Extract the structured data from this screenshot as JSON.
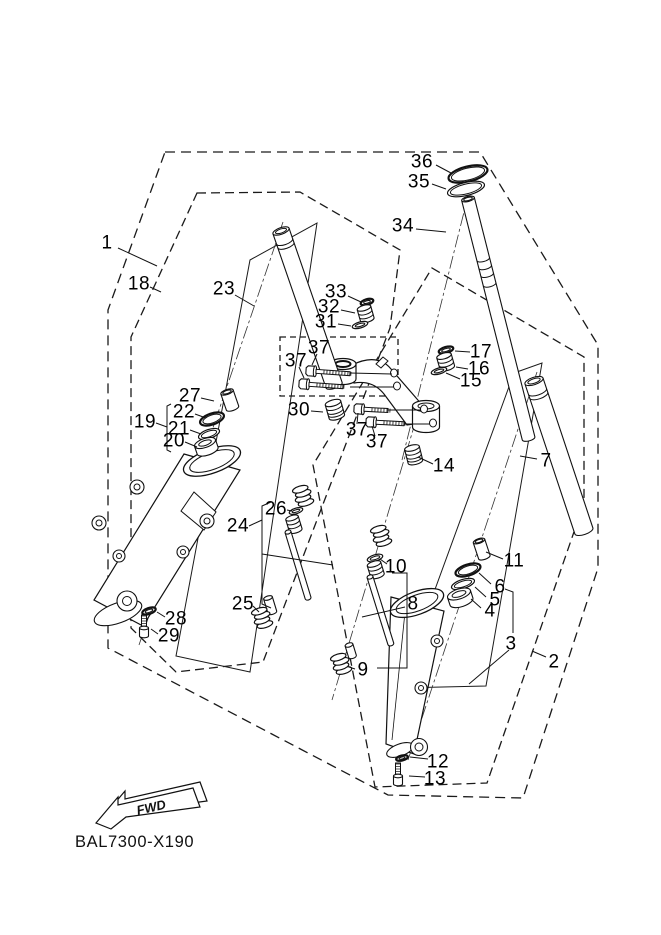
{
  "diagram": {
    "drawing_code": "BAL7300-X190",
    "fwd_label": "FWD",
    "callouts": [
      {
        "n": "1",
        "x": 107,
        "y": 243,
        "leader": [
          118,
          248,
          157,
          266
        ]
      },
      {
        "n": "18",
        "x": 139,
        "y": 284,
        "leader": [
          150,
          287,
          161,
          292
        ]
      },
      {
        "n": "23",
        "x": 224,
        "y": 289,
        "leader": [
          235,
          295,
          254,
          306
        ]
      },
      {
        "n": "36",
        "x": 422,
        "y": 162,
        "leader": [
          436,
          165,
          451,
          173
        ]
      },
      {
        "n": "35",
        "x": 419,
        "y": 182,
        "leader": [
          432,
          184,
          446,
          189
        ]
      },
      {
        "n": "34",
        "x": 403,
        "y": 226,
        "leader": [
          416,
          229,
          446,
          232
        ]
      },
      {
        "n": "33",
        "x": 336,
        "y": 292,
        "leader": [
          348,
          296,
          361,
          302
        ]
      },
      {
        "n": "32",
        "x": 329,
        "y": 307,
        "leader": [
          341,
          310,
          355,
          313
        ]
      },
      {
        "n": "31",
        "x": 326,
        "y": 322,
        "leader": [
          338,
          324,
          351,
          326
        ]
      },
      {
        "n": "17",
        "x": 481,
        "y": 352,
        "leader": [
          470,
          352,
          455,
          351
        ]
      },
      {
        "n": "16",
        "x": 479,
        "y": 369,
        "leader": [
          468,
          369,
          456,
          367
        ]
      },
      {
        "n": "15",
        "x": 471,
        "y": 381,
        "leader": [
          460,
          379,
          446,
          373
        ]
      },
      {
        "n": "37",
        "x": 319,
        "y": 348,
        "leader": [
          317,
          354,
          312,
          365
        ]
      },
      {
        "n": "37",
        "x": 296,
        "y": 361,
        "leader": [
          299,
          367,
          304,
          378
        ]
      },
      {
        "n": "30",
        "x": 299,
        "y": 410,
        "leader": [
          311,
          411,
          323,
          412
        ]
      },
      {
        "n": "37",
        "x": 357,
        "y": 430,
        "leader": [
          357,
          424,
          358,
          413
        ]
      },
      {
        "n": "37",
        "x": 377,
        "y": 442,
        "leader": [
          375,
          436,
          372,
          426
        ]
      },
      {
        "n": "27",
        "x": 190,
        "y": 396,
        "leader": [
          201,
          398,
          214,
          401
        ]
      },
      {
        "n": "22",
        "x": 184,
        "y": 412,
        "leader": [
          195,
          414,
          206,
          418
        ]
      },
      {
        "n": "21",
        "x": 179,
        "y": 429,
        "leader": [
          190,
          430,
          201,
          434
        ]
      },
      {
        "n": "20",
        "x": 174,
        "y": 441,
        "leader": [
          185,
          442,
          197,
          447
        ]
      },
      {
        "n": "19",
        "x": 145,
        "y": 422,
        "leader": [
          156,
          423,
          167,
          427
        ]
      },
      {
        "n": "14",
        "x": 444,
        "y": 466,
        "leader": [
          433,
          464,
          418,
          457
        ]
      },
      {
        "n": "24",
        "x": 238,
        "y": 526,
        "leader": [
          249,
          526,
          262,
          520
        ]
      },
      {
        "n": "26",
        "x": 276,
        "y": 509,
        "leader": [
          287,
          510,
          292,
          511
        ]
      },
      {
        "n": "25",
        "x": 243,
        "y": 604,
        "leader": [
          253,
          606,
          259,
          612
        ]
      },
      {
        "n": "10",
        "x": 396,
        "y": 567,
        "leader": [
          387,
          564,
          380,
          559
        ]
      },
      {
        "n": "8",
        "x": 413,
        "y": 604,
        "leader": [
          405,
          607,
          362,
          617
        ]
      },
      {
        "n": "9",
        "x": 363,
        "y": 670,
        "leader": [
          355,
          669,
          349,
          667
        ]
      },
      {
        "n": "7",
        "x": 546,
        "y": 461,
        "leader": [
          537,
          459,
          520,
          456
        ]
      },
      {
        "n": "11",
        "x": 514,
        "y": 561,
        "leader": [
          503,
          559,
          486,
          552
        ]
      },
      {
        "n": "6",
        "x": 500,
        "y": 587,
        "leader": [
          491,
          584,
          479,
          573
        ]
      },
      {
        "n": "5",
        "x": 495,
        "y": 600,
        "leader": [
          486,
          597,
          475,
          587
        ]
      },
      {
        "n": "4",
        "x": 490,
        "y": 611,
        "leader": [
          481,
          608,
          471,
          599
        ]
      },
      {
        "n": "3",
        "x": 511,
        "y": 644,
        "leader": [
          509,
          650,
          469,
          684
        ]
      },
      {
        "n": "2",
        "x": 554,
        "y": 662,
        "leader": [
          546,
          657,
          532,
          651
        ]
      },
      {
        "n": "28",
        "x": 176,
        "y": 619,
        "leader": [
          165,
          617,
          157,
          612
        ]
      },
      {
        "n": "29",
        "x": 169,
        "y": 636,
        "leader": [
          158,
          634,
          151,
          629
        ]
      },
      {
        "n": "12",
        "x": 438,
        "y": 762,
        "leader": [
          428,
          759,
          410,
          757
        ]
      },
      {
        "n": "13",
        "x": 435,
        "y": 779,
        "leader": [
          425,
          777,
          409,
          776
        ]
      }
    ]
  }
}
